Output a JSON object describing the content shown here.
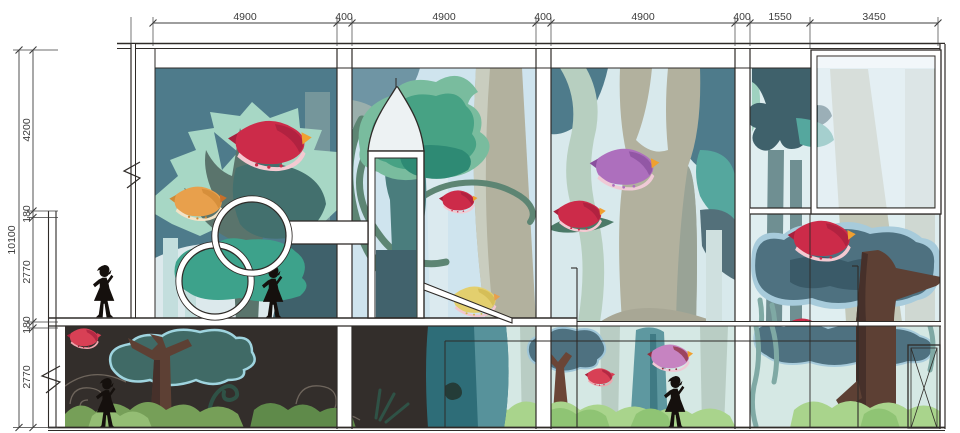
{
  "drawing": {
    "kind": "interior-elevation-with-forest-mural",
    "dimensions": {
      "top": [
        "4900",
        "400",
        "4900",
        "400",
        "4900",
        "400",
        "1550",
        "3450"
      ],
      "left_segments": [
        "4200",
        "180",
        "2770",
        "180",
        "2770"
      ],
      "overall_left": "10100"
    }
  },
  "palette": {
    "white": "#ffffff",
    "line": "#2f2b28",
    "dim": "#3d3d3d",
    "slate": "#4e7b8b",
    "slateSoft": "#6f95a4",
    "olive": "#5a746c",
    "oliveDeep": "#43706e",
    "mint": "#a7d7c5",
    "mintSoft": "#cfe6da",
    "tealBright": "#3da28b",
    "canopyOut": "#79bc9e",
    "canopyIn": "#47a284",
    "canopyDark": "#2e8a74",
    "sky": "#cfe4ee",
    "pale1": "#dce9ec",
    "pale2": "#d8e9ec",
    "pale3": "#dfeef0",
    "glass": "#e8f1f6",
    "tan": "#b2b19e",
    "tanLight": "#c9cdbf",
    "tanShadow": "#99a396",
    "sage": "#b7cfc0",
    "grayTrunk": "#6f8f92",
    "grayPale": "#b9cdc4",
    "steel": "#4e7180",
    "steelLight": "#a7cbdb",
    "steelDark": "#3a5a68",
    "tealTrunk": "#5e98a0",
    "tealTrunkDeep": "#2e6d78",
    "brown": "#5d4034",
    "brownDark": "#46302a",
    "darkbg": "#332e2b",
    "red": "#cc2b49",
    "redDark": "#a8203d",
    "pink": "#f4c9d1",
    "orange": "#e8a04c",
    "yellow": "#e3cf6e",
    "purple": "#ad6fbd",
    "bushA": "#a9d48c",
    "bushB": "#8fc474",
    "bushDim": "#769f58",
    "bushDim2": "#5f8a4a",
    "sil": "#15100d",
    "swirl": "#6e655c",
    "vine": "#5d8573",
    "moss": "#7fa9a4",
    "darkTeal": "#3f616b",
    "paleTrunk": "#c3dedd",
    "fern": "#2f5246"
  }
}
